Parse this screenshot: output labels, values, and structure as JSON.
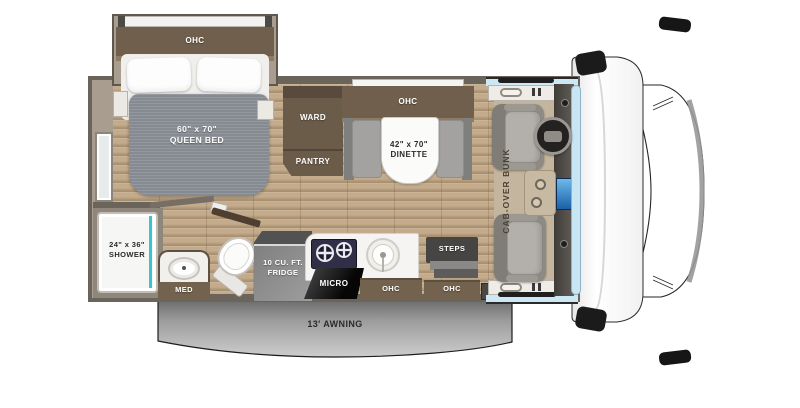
{
  "floorplan": {
    "bedroom": {
      "ohc_label": "OHC",
      "bed": {
        "size": "60\" x 70\"",
        "name": "QUEEN BED"
      }
    },
    "wardrobe": {
      "ward_label": "WARD",
      "pantry_label": "PANTRY"
    },
    "dinette": {
      "ohc_label": "OHC",
      "size": "42\" x 70\"",
      "name": "DINETTE"
    },
    "bathroom": {
      "shower_size": "24\" x 36\"",
      "shower_name": "SHOWER",
      "med_label": "MED"
    },
    "galley": {
      "fridge_line1": "10 CU. FT.",
      "fridge_line2": "FRIDGE",
      "micro_label": "MICRO",
      "ohc_label": "OHC"
    },
    "entry": {
      "steps_label": "STEPS",
      "ohc_label": "OHC",
      "tv_label": "TV"
    },
    "cab": {
      "bunk_line1": "CAB-OVER",
      "bunk_line2": "BUNK"
    },
    "exterior": {
      "awning_label": "13' AWNING"
    }
  },
  "colors": {
    "floor_wood": "#c3ab8c",
    "cabinet_brown": "#6f5f4c",
    "wall": "#6b645a",
    "mattress_gray": "#868a91",
    "shower_teal": "#3cc3cd",
    "window_blue": "#cde8f5",
    "screen_blue": "#1b5fa8",
    "awning_gray": "#9c9c9c"
  }
}
